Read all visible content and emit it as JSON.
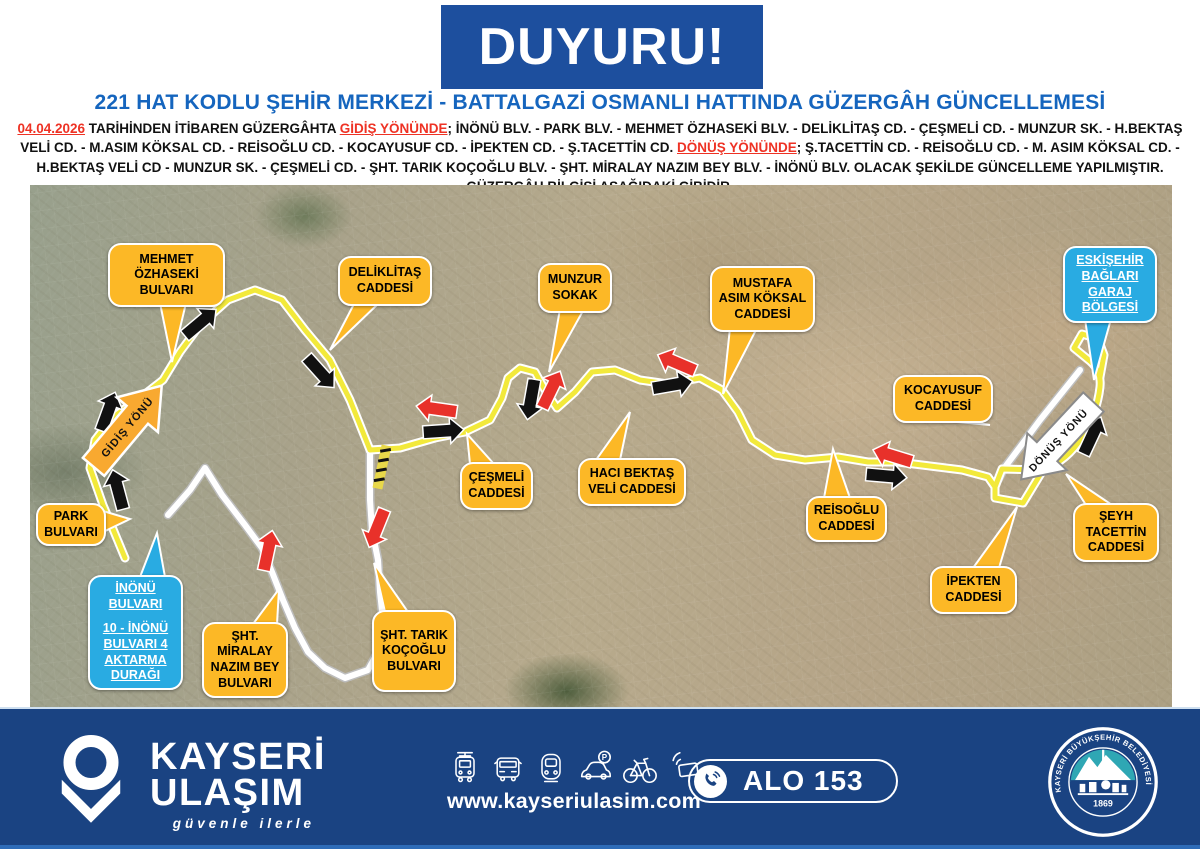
{
  "announcement": {
    "title": "DUYURU!",
    "subtitle": "221 HAT KODLU ŞEHİR MERKEZİ - BATTALGAZİ OSMANLI HATTINDA GÜZERGÂH GÜNCELLEMESİ",
    "body": {
      "date": "04.04.2026",
      "seg1": " TARİHİNDEN İTİBAREN GÜZERGÂHTA ",
      "gidis_label": "GİDİŞ YÖNÜNDE",
      "seg2": "; İNÖNÜ BLV. - PARK BLV. - MEHMET ÖZHASEKİ BLV. - DELİKLİTAŞ CD. - ÇEŞMELİ CD. - MUNZUR SK. - H.BEKTAŞ VELİ CD. - M.ASIM KÖKSAL CD. - REİSOĞLU CD. - KOCAYUSUF CD. - İPEKTEN CD. - Ş.TACETTİN CD. ",
      "donus_label": "DÖNÜŞ YÖNÜNDE",
      "seg3": "; Ş.TACETTİN CD. - REİSOĞLU CD. - M. ASIM KÖKSAL CD. - H.BEKTAŞ VELİ CD - MUNZUR SK. - ÇEŞMELİ CD. - ŞHT. TARIK KOÇOĞLU BLV. - ŞHT. MİRALAY NAZIM BEY BLV. - İNÖNÜ BLV. OLACAK ŞEKİLDE GÜNCELLEME YAPILMIŞTIR. GÜZERGÂH BİLGİSİ AŞAĞIDAKİ GİBİDİR."
    }
  },
  "map": {
    "gidis_arrow_label": "GİDİŞ YÖNÜ",
    "donus_arrow_label": "DÖNÜŞ YÖNÜ",
    "callouts": [
      "MEHMET ÖZHASEKİ BULVARI",
      "DELİKLİTAŞ CADDESİ",
      "MUNZUR SOKAK",
      "MUSTAFA ASIM KÖKSAL CADDESİ",
      "KOCAYUSUF CADDESİ",
      "ÇEŞMELİ CADDESİ",
      "HACI BEKTAŞ VELİ CADDESİ",
      "REİSOĞLU CADDESİ",
      "İPEKTEN CADDESİ",
      "ŞEYH TACETTİN CADDESİ",
      "PARK BULVARI",
      "ŞHT. MİRALAY NAZIM BEY BULVARI",
      "ŞHT. TARIK KOÇOĞLU BULVARI"
    ],
    "info_callouts": {
      "garage": "ESKİŞEHİR BAĞLARI GARAJ BÖLGESİ",
      "transfer_line1": "İNÖNÜ BULVARI",
      "transfer_line2": "10 - İNÖNÜ BULVARI 4 AKTARMA DURAĞI"
    },
    "colors": {
      "route_gidis": "#F2E93B",
      "route_donus": "#FFFFFF",
      "callout_yellow": "#FCB826",
      "callout_blue": "#29ABE2",
      "arrow_gidis": "#111111",
      "arrow_donus": "#E8312A",
      "gidis_big_arrow": "#F8A930"
    }
  },
  "footer": {
    "brand_line1": "KAYSERİ",
    "brand_line2": "ULAŞIM",
    "tagline": "güvenle ilerle",
    "website": "www.kayseriulasim.com",
    "hotline": "ALO 153",
    "parking_letter": "P",
    "emblem_text": "KAYSERİ BÜYÜKŞEHİR BELEDİYESİ",
    "emblem_year": "1869",
    "icons": [
      "tram-icon",
      "bus-icon",
      "metro-icon",
      "car-parking-icon",
      "bicycle-icon",
      "contactless-card-icon",
      "phone-icon"
    ]
  },
  "colors": {
    "header_navy": "#1D4F9E",
    "subtitle_blue": "#1565BE",
    "footer_navy": "#1A4382",
    "alert_red": "#EE3224"
  }
}
